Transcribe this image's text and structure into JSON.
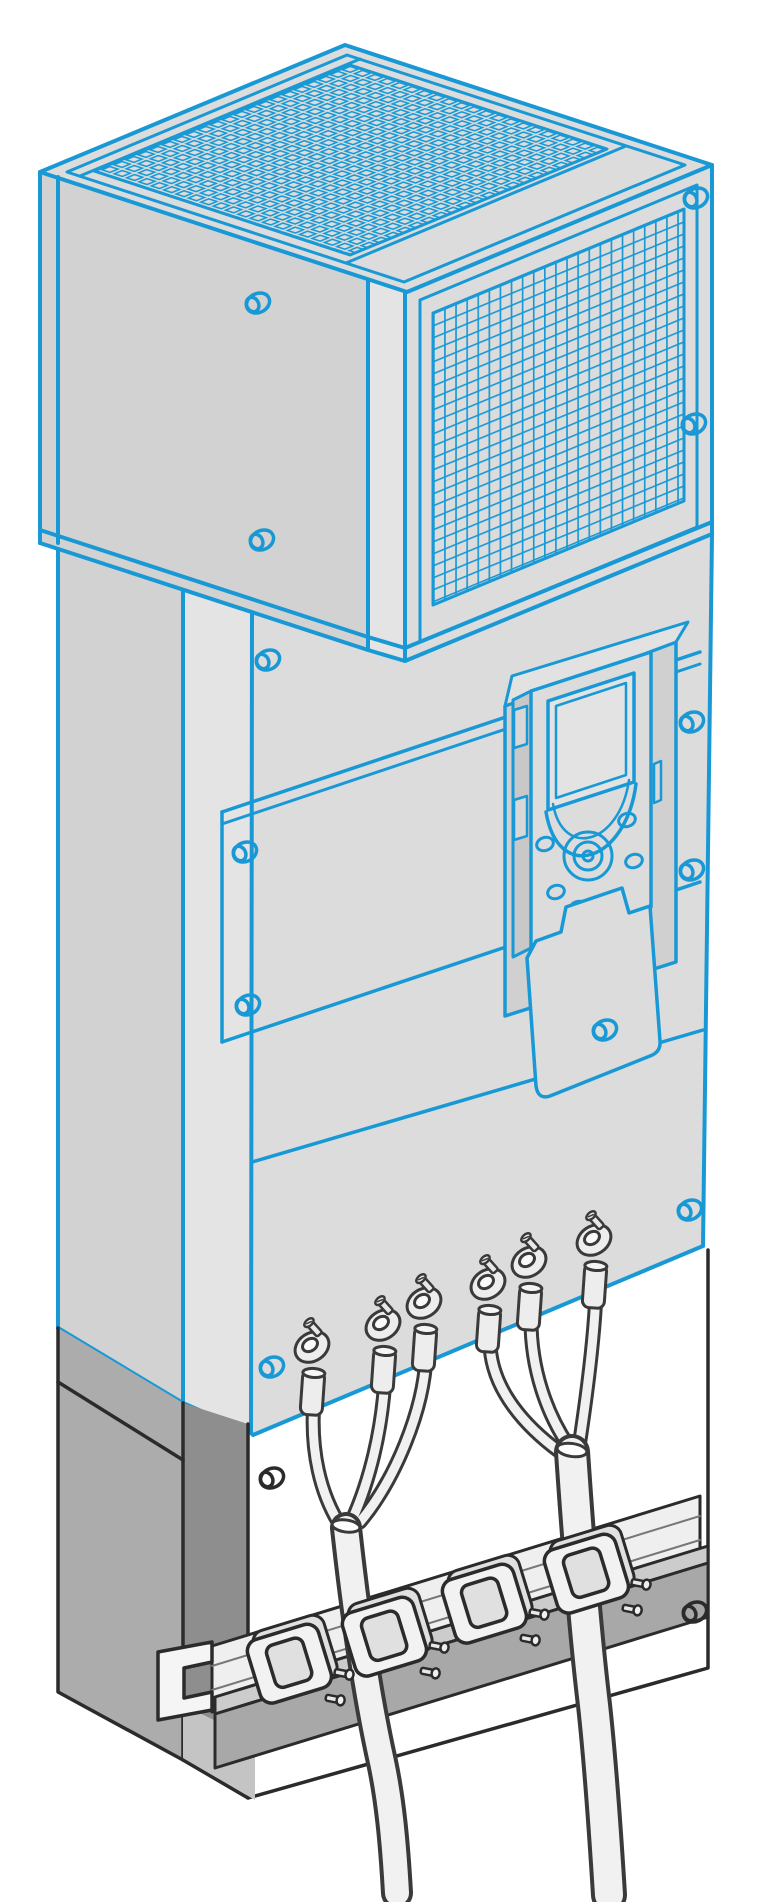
{
  "illustration": {
    "description": "Isometric technical line drawing of a variable speed drive cabinet: ventilation grille unit on top, graphic display keypad on the front, six ring-lug power cables leaving the bottom of the enclosure, routed as two bundles through cable clamps on a mounting rail inside the open plinth base",
    "background": "#ffffff",
    "line_colors": {
      "cabinet_outline": "#1899d6",
      "plinth_outline": "#2b2b2b",
      "hardware_outline": "#3a3a3a"
    },
    "fill_colors": {
      "panel": "#dcdcdc",
      "panel_side": "#d2d2d2",
      "panel_bevel": "#e4e4e4",
      "recess": "#d0d0d0",
      "flange": "#e2e2e2",
      "keypad_side": "#c8c8c8",
      "screen": "#e3e3e3",
      "plinth_side": "#acacac",
      "plinth_side_dark": "#8e8e8e",
      "floor_wedge": "#c4c4c4",
      "bar_front": "#a8a8a8",
      "bar_top": "#cccccc",
      "rail": "#efefef",
      "hardware": "#ededed",
      "cable": "#f1f1f1"
    },
    "counts": {
      "cable_lugs": 6,
      "cable_clamps": 4,
      "cable_bundles": 2,
      "cabinet_screws": 12,
      "plinth_screws": 2
    },
    "parts": {
      "vent_unit": "ventilation grille unit",
      "top_grille": "top perforated grille",
      "front_grille": "front wire-mesh grille",
      "cabinet": "drive cabinet body",
      "keypad": "graphic display keypad",
      "keypad_screen": "keypad display screen",
      "keypad_wheel": "navigation wheel",
      "terminal_flap": "keypad lower flap",
      "lугs": "power cable ring lugs",
      "rail": "mounting C-rail",
      "clamps": "cable clamps",
      "floor_bar": "plinth floor bar",
      "cables": "power cable bundles",
      "plinth": "open plinth base"
    }
  }
}
